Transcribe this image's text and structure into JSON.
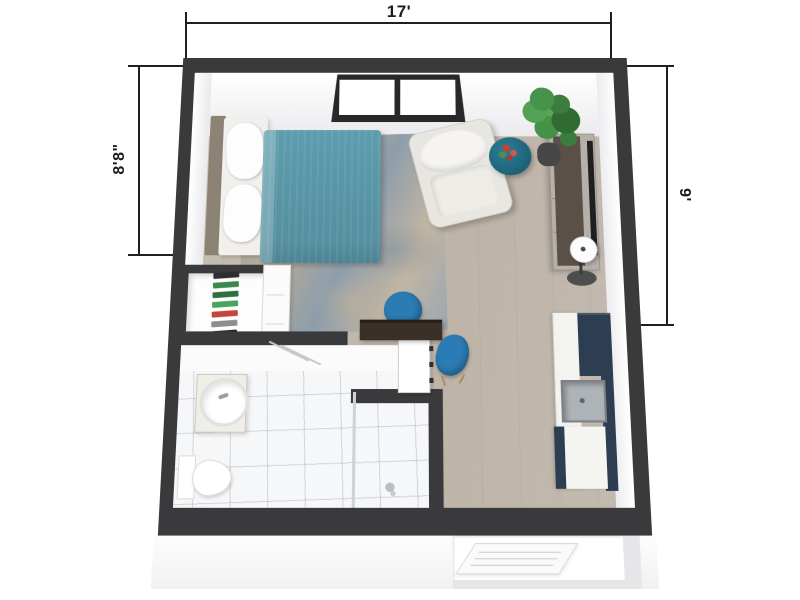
{
  "title": "Studio apartment 3D floor plan",
  "dimensions": {
    "top": "17'",
    "left": "8'8\"",
    "right": "9'"
  },
  "colors": {
    "line": "#1f1f1f",
    "wall": "#3a3a3c",
    "floor": "#c7beb3",
    "tile": "#f6f7f8",
    "rug_a": "#93a2ae",
    "rug_b": "#b9ac97",
    "bed": "#5d9dad",
    "headboard": "#8d8374",
    "chair_blue": "#2b7cb4",
    "armchair": "#e8e6e0",
    "pouf": "#1d6277",
    "cabinet_navy": "#2e3e52",
    "desk_brown": "#3a3027",
    "console_brown": "#5a5047",
    "plant_green": "#47934b",
    "pot": "#474747"
  },
  "closet_shelf_items": [
    "#2e2e2e",
    "#3c8a4a",
    "#2e7040",
    "#49a45c",
    "#c4453a",
    "#8e8e8e",
    "#262626"
  ],
  "objects": [
    "double-bed",
    "pillows",
    "headboard",
    "area-rug",
    "window",
    "armchair",
    "side-table-with-flowers",
    "potted-plant",
    "media-console",
    "tv",
    "floor-lamp",
    "closet-shelves",
    "dresser",
    "desk",
    "desk-chairs",
    "bathroom",
    "vanity-sink",
    "toilet",
    "shower",
    "towel-bars",
    "kitchen-counter",
    "kitchen-sink",
    "tall-cabinet",
    "entry-door"
  ]
}
